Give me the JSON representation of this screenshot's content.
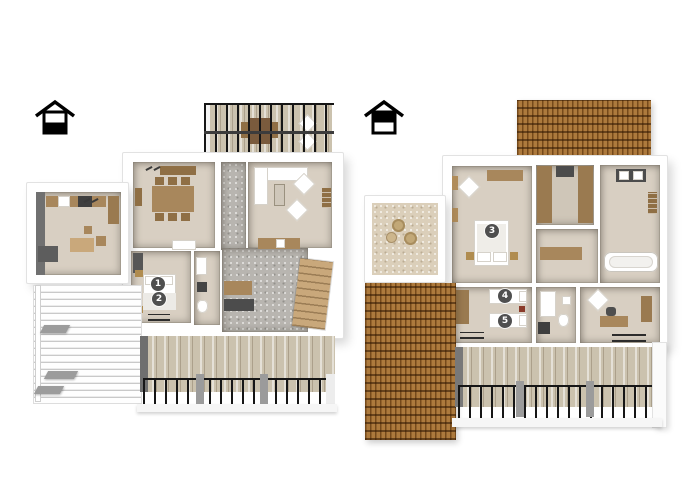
{
  "page": {
    "background_color": "#ffffff",
    "content": "3D floor plan, two storeys shown side by side"
  },
  "floors": [
    {
      "id": "ground-floor",
      "icon": "house-ground-floor-icon",
      "markers": [
        {
          "label": "1"
        },
        {
          "label": "2"
        }
      ]
    },
    {
      "id": "upper-floor",
      "icon": "house-upper-floor-icon",
      "markers": [
        {
          "label": "3"
        },
        {
          "label": "4"
        },
        {
          "label": "5"
        }
      ]
    }
  ],
  "colors": {
    "wall": "#ffffff",
    "floor_beige": "#d8cfc2",
    "carpet_gray": "#b8b5b0",
    "wood": "#a8875c",
    "wood_dark": "#8f6f45",
    "appliance_dark": "#4c4c4c",
    "roof_tile": "#a26a2a",
    "deck": "#cbc2ae",
    "railing": "#161616",
    "marker_background": "#4f4f4f",
    "marker_text": "#ffffff"
  }
}
